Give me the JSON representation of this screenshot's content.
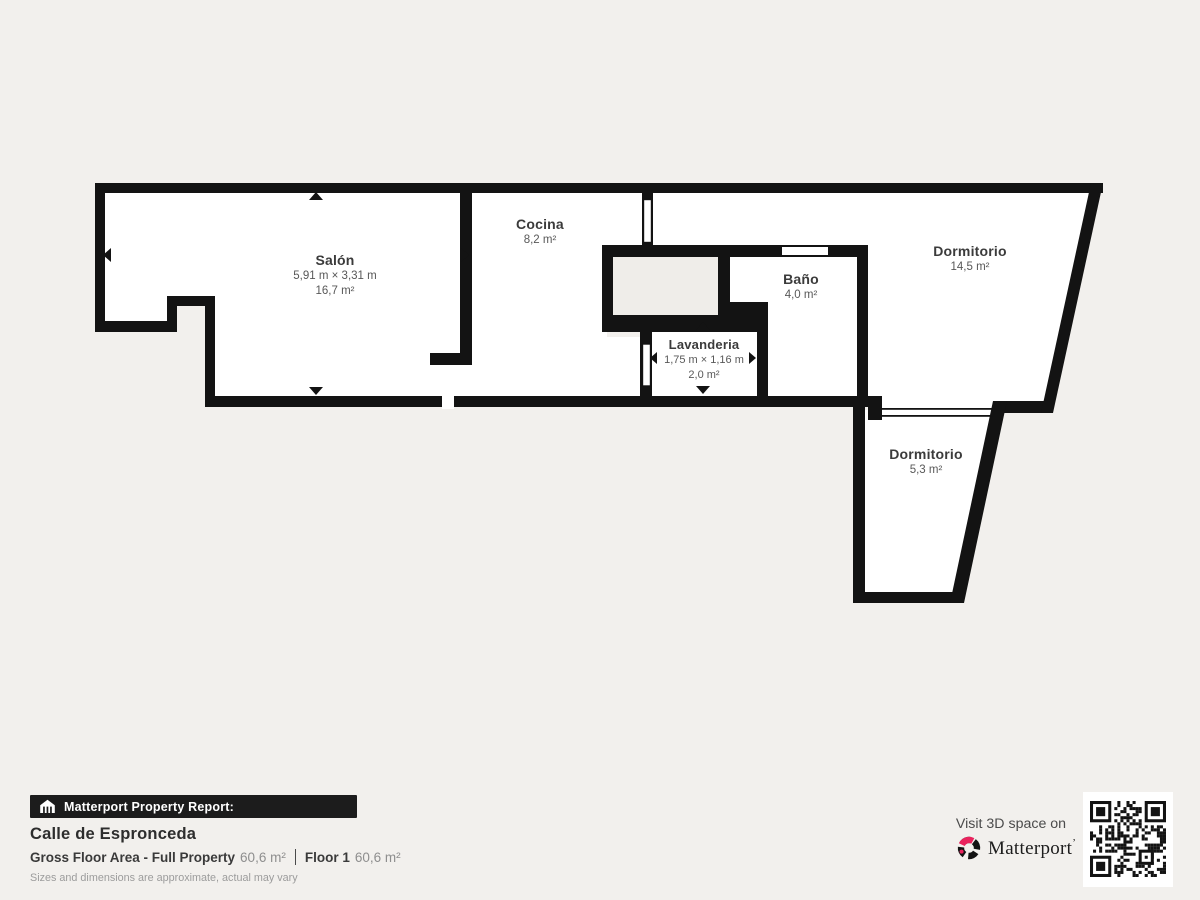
{
  "plan": {
    "rooms": [
      {
        "id": "salon",
        "name": "Salón",
        "dims": "5,91 m × 3,31 m",
        "area": "16,7 m²"
      },
      {
        "id": "cocina",
        "name": "Cocina",
        "dims": "",
        "area": "8,2 m²"
      },
      {
        "id": "lavanderia",
        "name": "Lavanderia",
        "dims": "1,75 m × 1,16 m",
        "area": "2,0 m²"
      },
      {
        "id": "bano",
        "name": "Baño",
        "dims": "",
        "area": "4,0 m²"
      },
      {
        "id": "dormitorio-1",
        "name": "Dormitorio",
        "dims": "",
        "area": "14,5 m²"
      },
      {
        "id": "dormitorio-2",
        "name": "Dormitorio",
        "dims": "",
        "area": "5,3 m²"
      }
    ],
    "colors": {
      "wall": "#131313",
      "room_fill": "#ffffff",
      "void_fill": "#efede9",
      "background": "#f2f0ed"
    },
    "icons": [
      "dimension-arrow-icon",
      "door-leaf-icon",
      "window-opening-icon"
    ]
  },
  "report": {
    "badge_icon": "house-icon",
    "badge_label": "Matterport Property Report:",
    "property_name": "Calle de Espronceda",
    "gross_label": "Gross Floor Area - Full Property",
    "gross_value": "60,6 m²",
    "floor_label": "Floor 1",
    "floor_value": "60,6 m²",
    "disclaimer": "Sizes and dimensions are approximate, actual may vary"
  },
  "cta": {
    "visit_label": "Visit 3D space on",
    "brand": "Matterport",
    "brand_mark": "’",
    "brand_icon": "matterport-swirl-icon",
    "qr_icon": "qr-code",
    "accent_color": "#e9235d"
  }
}
